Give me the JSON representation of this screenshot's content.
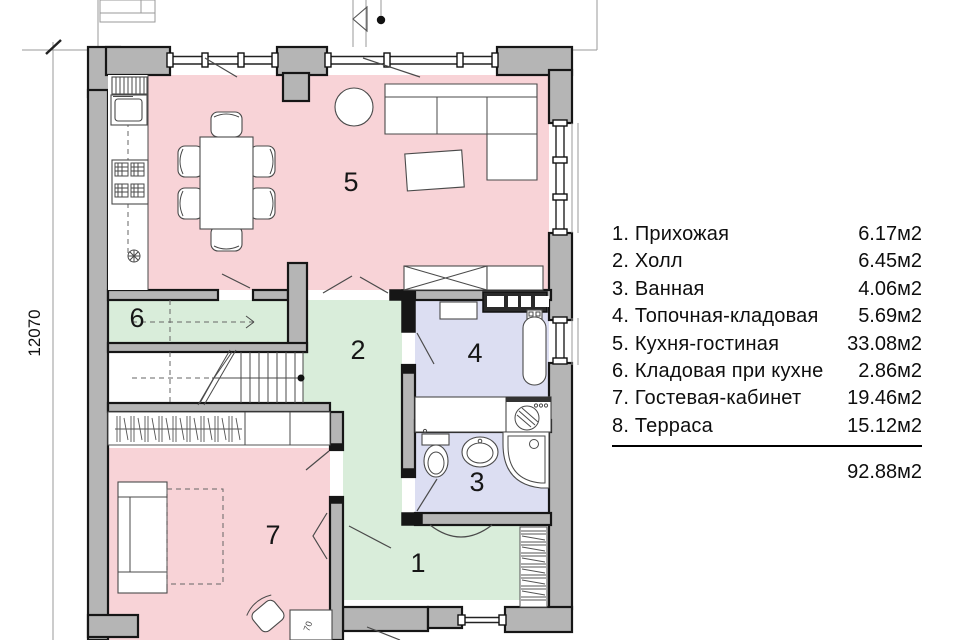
{
  "legend": {
    "items": [
      {
        "label": "1.  Прихожая",
        "area": "6.17м2"
      },
      {
        "label": "2.  Холл",
        "area": "6.45м2"
      },
      {
        "label": "3.  Ванная",
        "area": "4.06м2"
      },
      {
        "label": "4.  Топочная-кладовая",
        "area": "5.69м2"
      },
      {
        "label": "5.  Кухня-гостиная",
        "area": "33.08м2"
      },
      {
        "label": "6.  Кладовая при кухне",
        "area": "2.86м2"
      },
      {
        "label": "7.  Гостевая-кабинет",
        "area": "19.46м2"
      },
      {
        "label": "8.  Терраса",
        "area": "15.12м2"
      }
    ],
    "total": "92.88м2"
  },
  "plan": {
    "dimension_left": "12070",
    "desk_dimension": "70",
    "rooms": {
      "r1": "1",
      "r2": "2",
      "r3": "3",
      "r4": "4",
      "r5": "5",
      "r6": "6",
      "r7": "7"
    }
  },
  "colors": {
    "room_pink": "#f8d3d7",
    "room_green": "#d9edda",
    "room_blue": "#dcdef2",
    "wall_gray": "#b5b5b5",
    "outline_black": "#161616",
    "furniture_line": "#4a4a4a",
    "text_black": "#0e0e0e"
  }
}
